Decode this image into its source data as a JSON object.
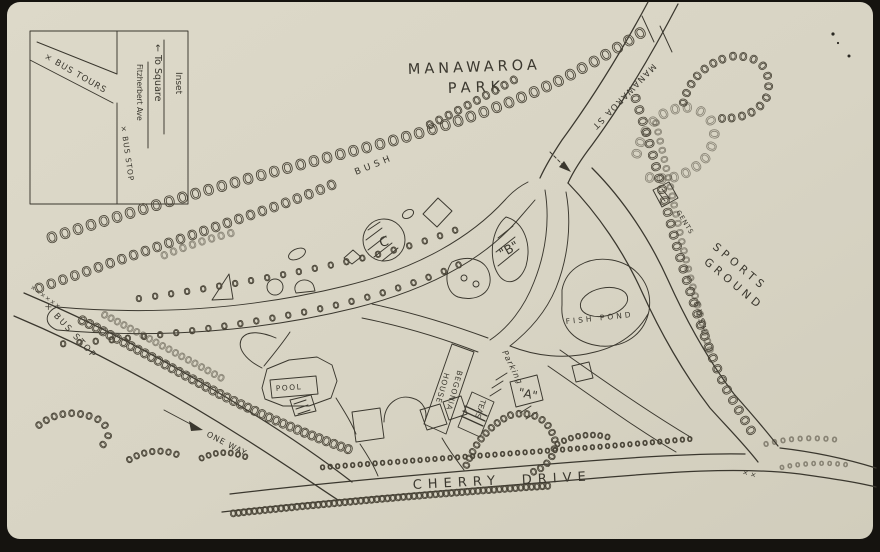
{
  "colors": {
    "background": "#15130f",
    "paper": "#d9d5c5",
    "ink": "#3a372e",
    "loop_pencil": "#4b4639"
  },
  "title": {
    "line1": "MANAWAROA",
    "line2": "PARK"
  },
  "inset": {
    "heading": "Inset",
    "direction": "← To Square",
    "street": "Fitzherbert Ave",
    "bus_tours": "× BUS TOURS",
    "bus_stop": "× BUS STOP"
  },
  "roads": {
    "manawaroa_st": "MANAWAROA ST",
    "cherry_word1": "CHERRY",
    "cherry_word2": "DRIVE",
    "one_way": "ONE WAY",
    "bus_stop": "× BUS STOP",
    "bus_stop_ticks": "××××××",
    "junction_ticks": "× ×"
  },
  "labels": {
    "bush_left": "BUSH",
    "bush_right": "BUSH",
    "sports_line1": "SPORTS",
    "sports_line2": "GROUND",
    "fish_pond": "FISH POND",
    "parking": "Parking",
    "pool": "POOL",
    "teas": "TEAS",
    "begonia_line1": "BEGONIA",
    "begonia_line2": "HOUSE",
    "gents": "GENTS",
    "marker_a": "\"A\"",
    "marker_b": "\"B\"",
    "marker_c": "C"
  },
  "decor": {
    "loop_chain": "oooooooooooooooooooooooooooooooooooooooooooooooooooooooooooo",
    "dotted_row": "o o o o o o o o o o o o o o o o o o o o o o o o o o o o o o o o o o o o o o o o "
  }
}
